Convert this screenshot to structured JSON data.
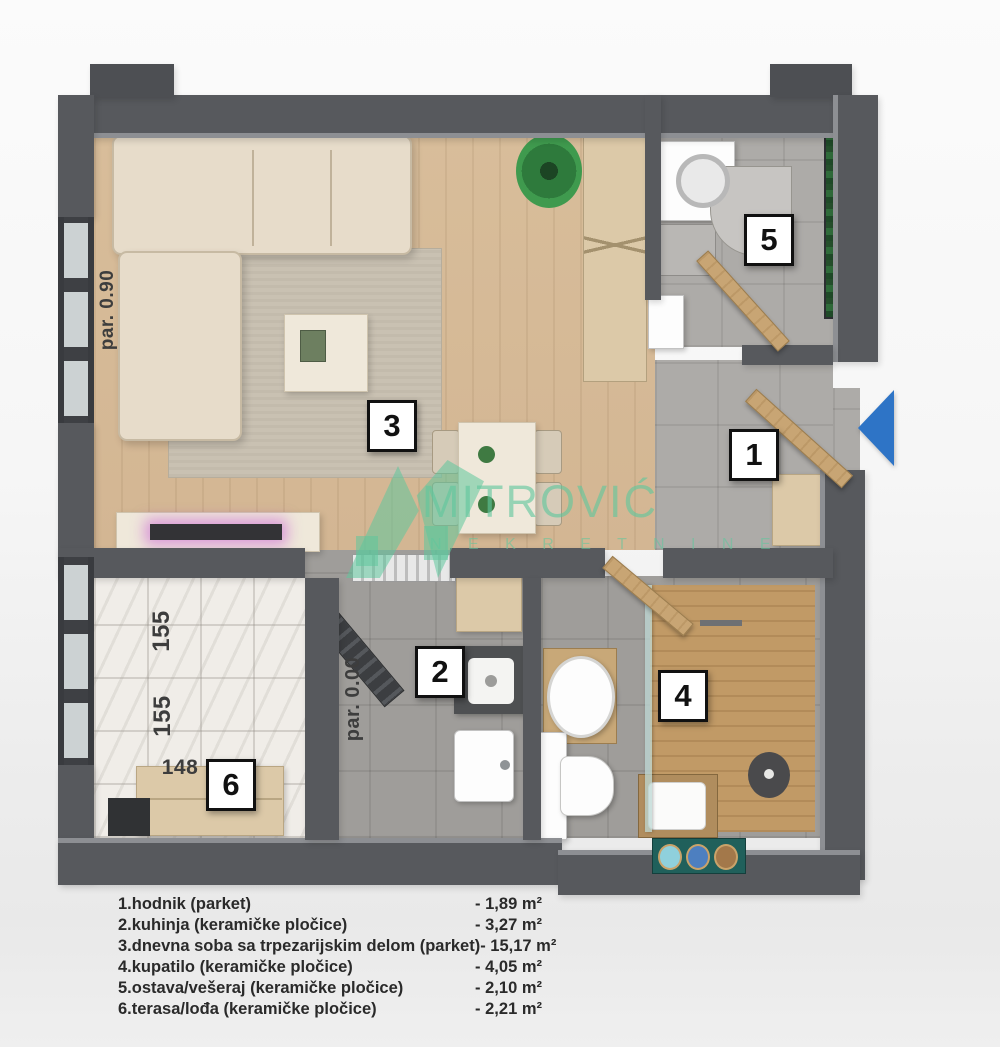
{
  "title_hint": "apartment floor plan",
  "room_markers": [
    "1",
    "2",
    "3",
    "4",
    "5",
    "6"
  ],
  "dimensions": {
    "parapet_left": "par. 0.90",
    "parapet_inner": "par. 0.00",
    "terrace_side_upper": "155",
    "terrace_side_lower": "155",
    "terrace_bottom": "148"
  },
  "watermark": {
    "brand": "MITROVIĆ",
    "subtitle": "N E K R E T N I N E"
  },
  "legend": {
    "items": [
      {
        "label": "1.hodnik (parket)",
        "area": "- 1,89 m²"
      },
      {
        "label": "2.kuhinja (keramičke pločice)",
        "area": "- 3,27 m²"
      },
      {
        "label": "3.dnevna soba sa trpezarijskim delom (parket)",
        "area": "- 15,17 m²"
      },
      {
        "label": "4.kupatilo (keramičke pločice)",
        "area": "- 4,05 m²"
      },
      {
        "label": "5.ostava/vešeraj (keramičke pločice)",
        "area": "- 2,10 m²"
      },
      {
        "label": "6.terasa/lođa (keramičke pločice)",
        "area": "- 2,21 m²"
      }
    ]
  },
  "colors": {
    "wall": "#57595d",
    "wood": "#d3b693",
    "wood_dark": "#c19a66",
    "tile": "#adaba8",
    "tile_dark": "#9f9d9a",
    "marble": "#f0ede8",
    "sofa": "#e7dcca",
    "accent": "#5fc79d",
    "arrow": "#2e74c6"
  }
}
